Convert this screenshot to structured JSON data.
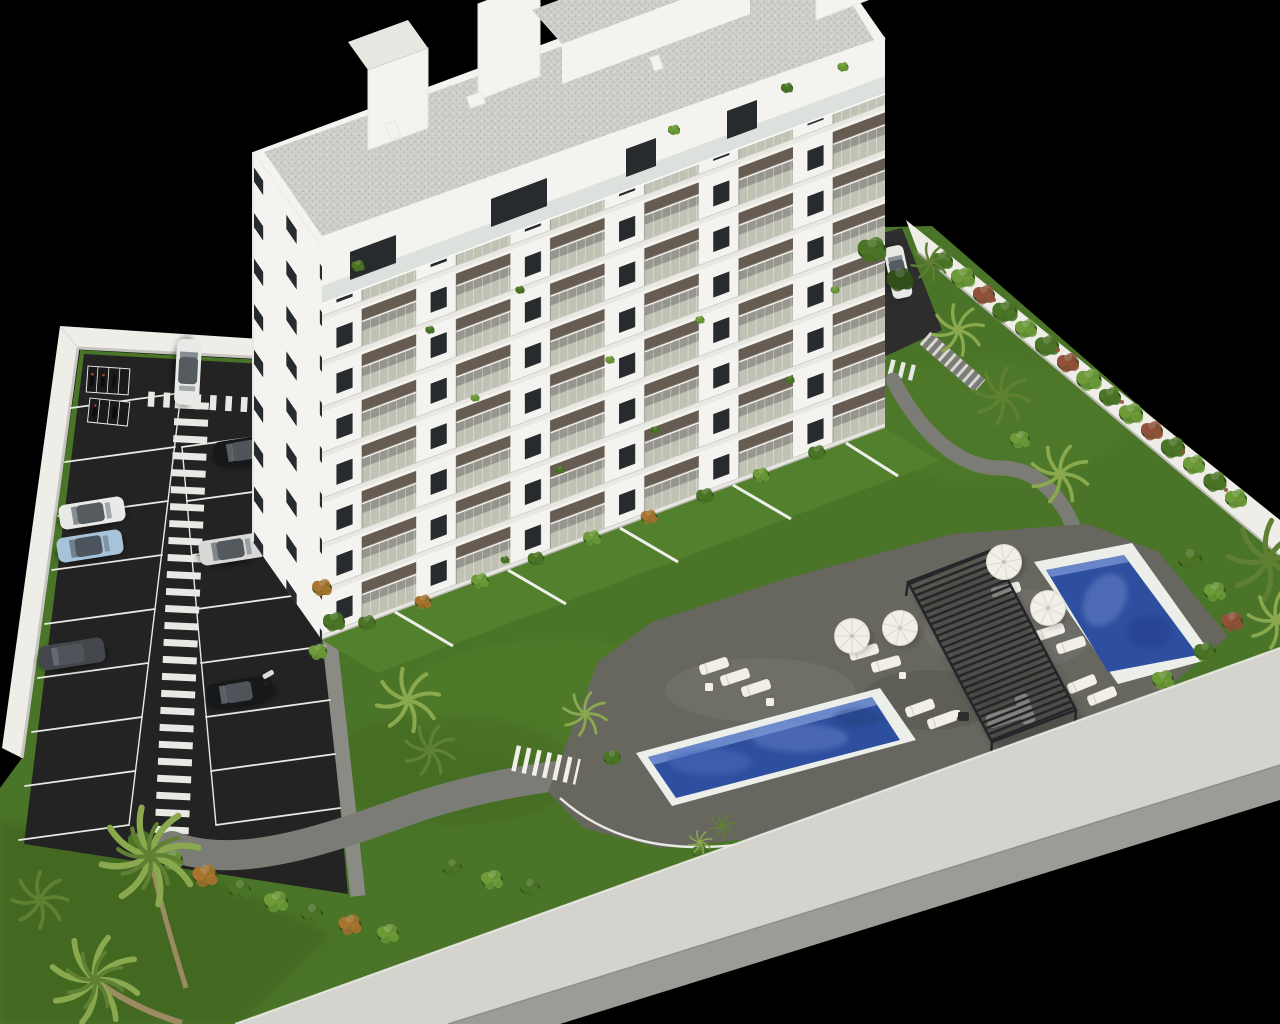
{
  "scene": {
    "description": "Aerial 3D architectural rendering of a white residential apartment tower with balconies and roof penthouses, set in a walled landscaped plot with a dark asphalt parking lot, pedestrian zebra walkways, parked cars, lawns, palm trees, flowering hedges, a grey leisure deck with a slatted pergola, white parasols and sun loungers, a long lap pool and a smaller rectangular pool, all on a black background",
    "type": "architectural-render",
    "background": "black",
    "building": {
      "material": "white render",
      "floors_visible": 9,
      "facade_bays": 6,
      "penthouse_volumes": 4,
      "balconies": "glass balustrades with potted plants",
      "roof": "flat gravel roof with chimneys"
    },
    "parking": {
      "surface": "dark asphalt",
      "stall_rows": 2,
      "stalls_per_row": 8,
      "motorbike_bays": 2,
      "zebra_walkway": "central longitudinal",
      "crosswalks": 2,
      "parked_cars": [
        "white",
        "light-blue",
        "dark-grey",
        "silver",
        "black",
        "black-with-open-door"
      ],
      "moving_cars": [
        "white hatchback near entrance",
        "white car at east service road"
      ],
      "person_visible": 1
    },
    "pools": {
      "count": 2,
      "lap_pool": "long rectangular, white rim, deep blue water",
      "small_pool": "rectangular, white rim, blue water"
    },
    "amenities": {
      "pergola": "dark slatted canopy",
      "parasols": 4,
      "sun_loungers": 12,
      "outdoor_sofa": 1,
      "deck_stairs": 1,
      "hillside_steps": 1
    },
    "landscape": {
      "lawns": "bright green",
      "palm_trees": 9,
      "hedges": "mixed green with orange and red flowering shrubs",
      "perimeter": "white boundary walls"
    }
  },
  "palette": {
    "bg": "#000000",
    "wall_top": "#eeede8",
    "wall_face": "#c6c5bf",
    "wall_band": "#d4d3ce",
    "wall_band_side": "#9c9b96",
    "asphalt": "#232323",
    "asphalt_light": "#2d2d2d",
    "line_white": "#e8e8e4",
    "sidewalk": "#8b8b85",
    "path": "#7c7c76",
    "deck": "#67665f",
    "grass": "#4a7427",
    "grass_dark": "#3c611f",
    "grass_light": "#5a8a30",
    "hedge_dark": "#2f4f1b",
    "hedge_mid": "#4b7526",
    "hedge_light": "#6d9b38",
    "hedge_accent": "#a9742f",
    "hedge_red": "#93503a",
    "palm": "#8aa84e",
    "palm_dark": "#5f8032",
    "trunk": "#9b8a62",
    "building_white": "#f4f3ef",
    "building_shade": "#e7e6e1",
    "slab": "#e9e8e2",
    "slab_line": "#c6c5bf",
    "recess_dark": "#5f564a",
    "recess_mid": "#8a8177",
    "balcony_floor": "#cfc8b5",
    "glass": "#aab8b4",
    "rail_white": "#fafaf8",
    "window_dark": "#272b2e",
    "roof_gravel": "#cfcec8",
    "roof_speck": "#b3b2ac",
    "water_deep": "#2e4f9f",
    "water_mid": "#4668b8",
    "water_light": "#7b97d4",
    "pool_rim": "#eceeea",
    "pergola": "#26262a",
    "furniture": "#f1efe8",
    "car_white": "#e9e9e7",
    "car_black": "#17181a",
    "car_blue": "#a6c3da",
    "car_gray": "#43474b",
    "car_silver": "#d8d9d7"
  }
}
